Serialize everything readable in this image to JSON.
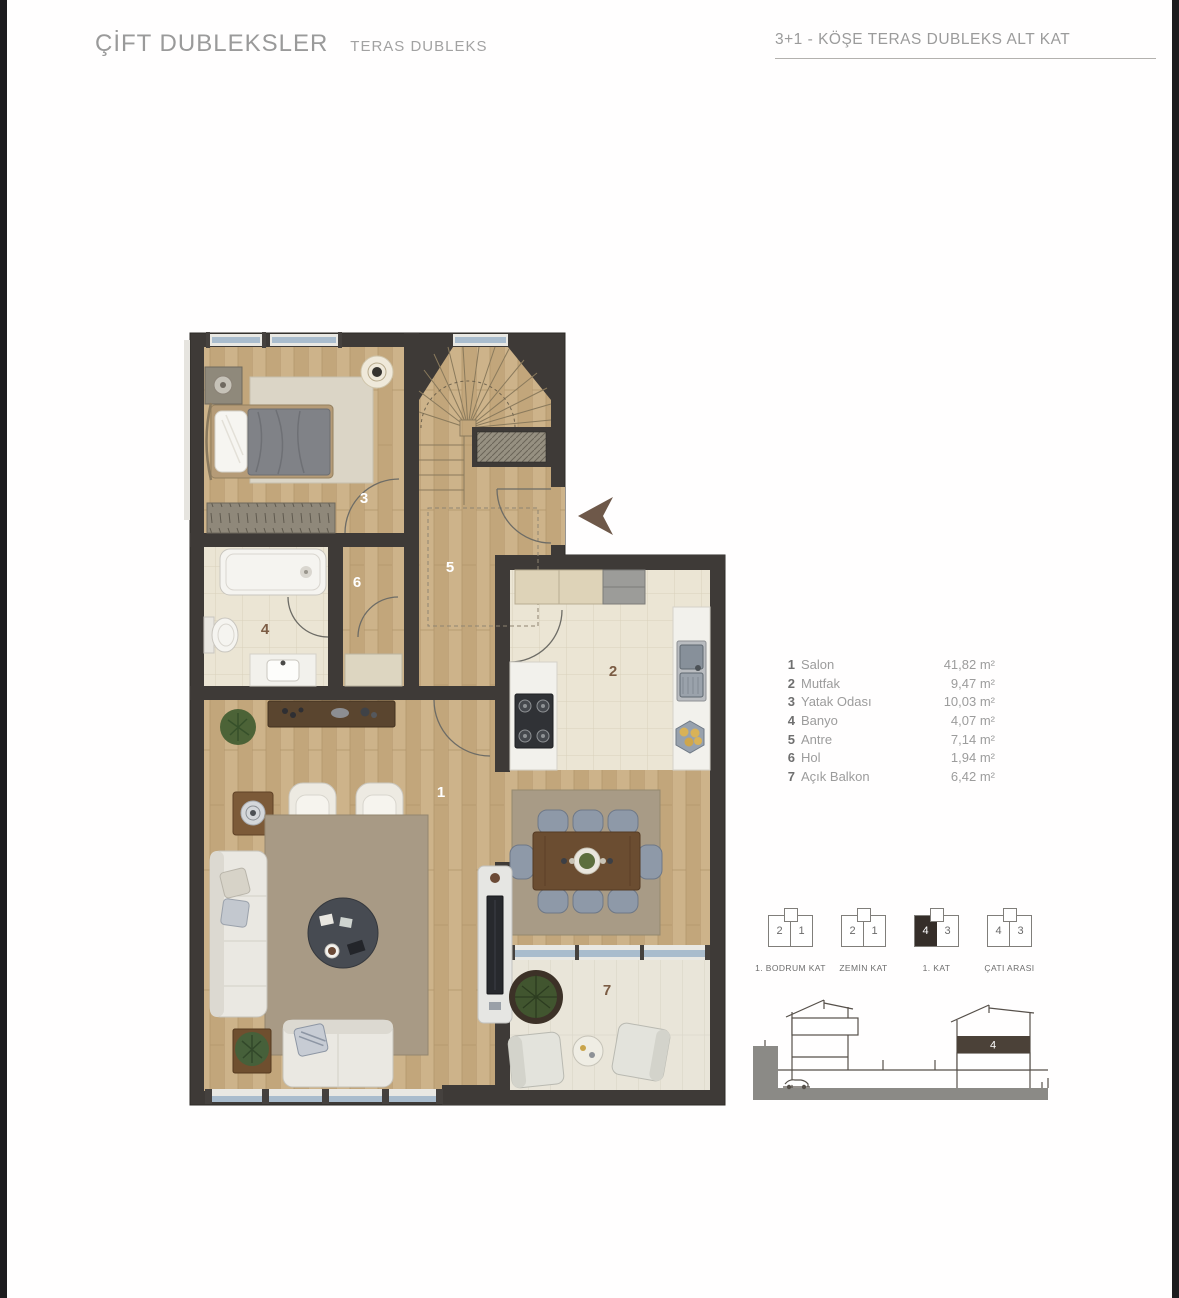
{
  "header": {
    "title": "ÇİFT DUBLEKSLER",
    "subtitle": "TERAS DUBLEKS",
    "plan_title": "3+1 - KÖŞE TERAS DUBLEKS ALT KAT"
  },
  "legend": {
    "rooms": [
      {
        "no": "1",
        "name": "Salon",
        "area": "41,82 m²"
      },
      {
        "no": "2",
        "name": "Mutfak",
        "area": "9,47 m²"
      },
      {
        "no": "3",
        "name": "Yatak Odası",
        "area": "10,03 m²"
      },
      {
        "no": "4",
        "name": "Banyo",
        "area": "4,07 m²"
      },
      {
        "no": "5",
        "name": "Antre",
        "area": "7,14 m²"
      },
      {
        "no": "6",
        "name": "Hol",
        "area": "1,94 m²"
      },
      {
        "no": "7",
        "name": "Açık Balkon",
        "area": "6,42 m²"
      }
    ]
  },
  "plan": {
    "room_numbers": {
      "salon": "1",
      "mutfak": "2",
      "yatak_odasi": "3",
      "banyo": "4",
      "antre": "5",
      "hol": "6",
      "acik_balkon": "7"
    }
  },
  "floor_diagrams": [
    {
      "left": "2",
      "right": "1",
      "label": "1. BODRUM KAT",
      "highlighted": ""
    },
    {
      "left": "2",
      "right": "1",
      "label": "ZEMİN KAT",
      "highlighted": ""
    },
    {
      "left": "4",
      "right": "3",
      "label": "1. KAT",
      "highlighted": "left"
    },
    {
      "left": "4",
      "right": "3",
      "label": "ÇATI ARASI",
      "highlighted": ""
    }
  ],
  "section": {
    "floor_label": "4"
  },
  "colors": {
    "wall": "#3e3a37",
    "wood": "#c8ad83",
    "accent_brown": "#7b5c44",
    "text_gray": "#9b9b9b"
  }
}
